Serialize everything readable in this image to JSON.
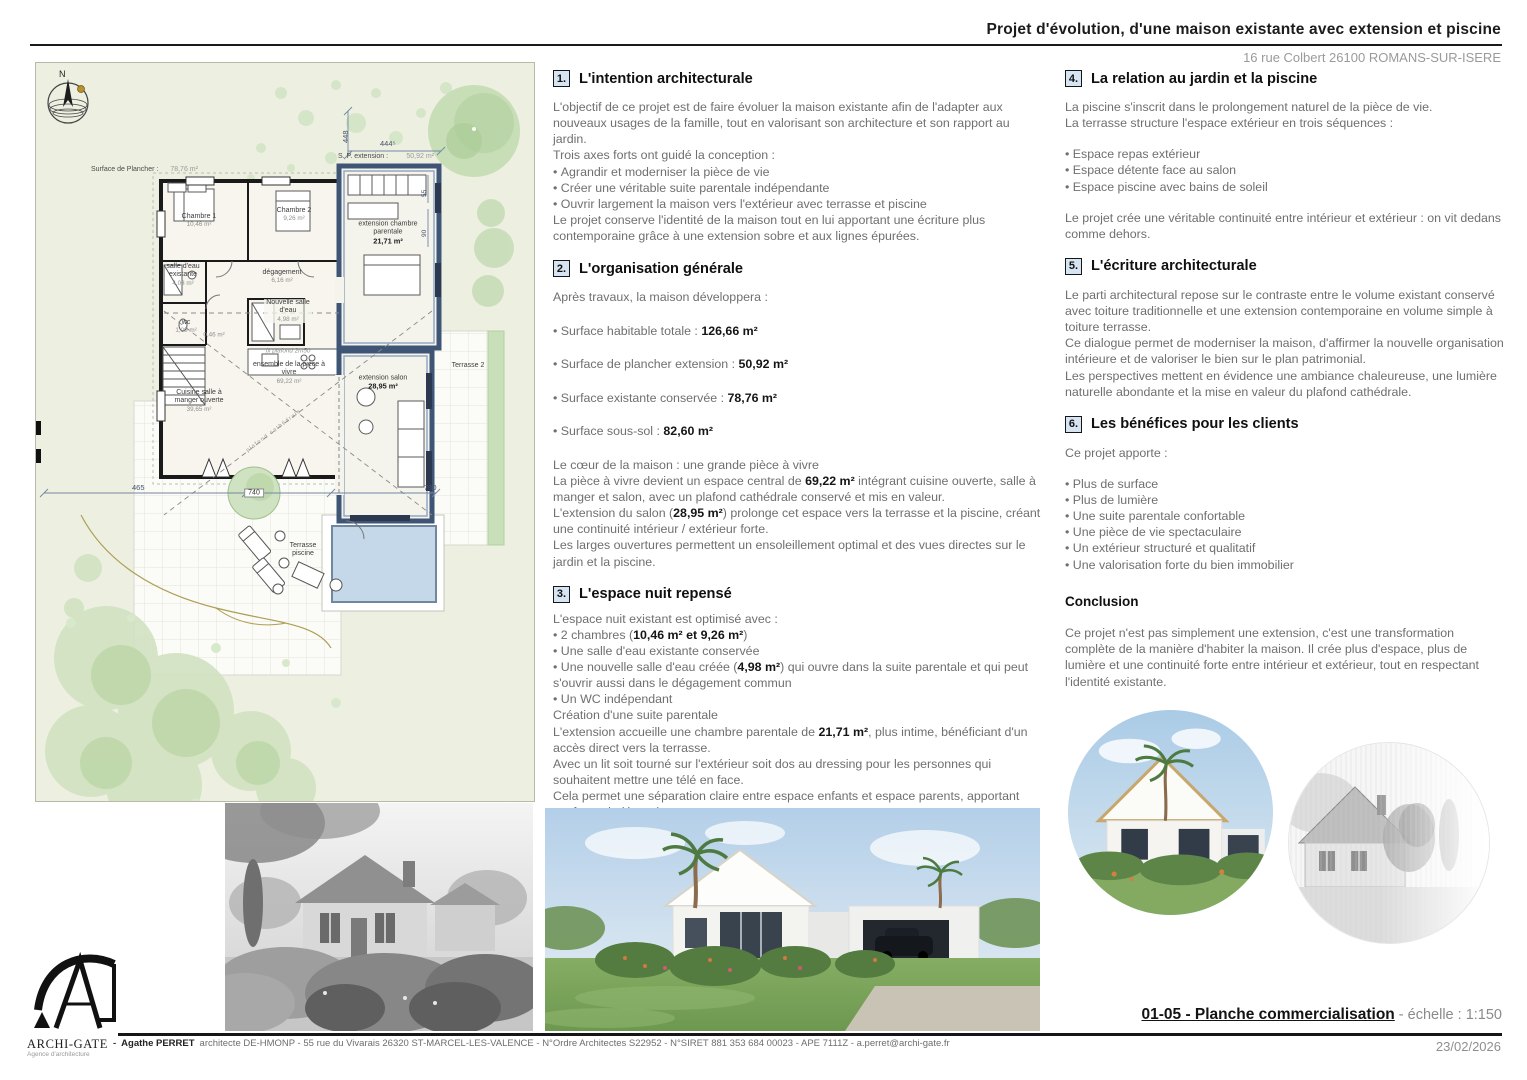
{
  "header": {
    "title": "Projet d'évolution, d'une maison existante avec extension et piscine",
    "address": "16 rue Colbert 26100 ROMANS-SUR-ISERE"
  },
  "plan": {
    "north": "N",
    "surface_plancher": {
      "label": "Surface de Plancher :",
      "value": "78,76 m²"
    },
    "sp_extension": {
      "label": "S. P. extension :",
      "value": "50,92 m²"
    },
    "rooms": {
      "chambre1": {
        "name": "Chambre 1",
        "area": "10,46 m²"
      },
      "chambre2": {
        "name": "Chambre 2",
        "area": "9,26 m²"
      },
      "salle_eau_existante": {
        "name": "salle d'eau existante",
        "area": "4,03 m²"
      },
      "degagement": {
        "name": "dégagement",
        "area": "6,16 m²"
      },
      "nouvelle_salle_eau": {
        "name": "Nouvelle salle d'eau",
        "area": "4,98 m²"
      },
      "wc": {
        "name": "wc",
        "area": "1,00 m²"
      },
      "placard": {
        "area": "0,46 m²"
      },
      "cuisine": {
        "name": "Cuisine salle à manger ouverte",
        "area": "39,65 m²"
      },
      "ensemble": {
        "name": "ensemble de la pièce à vivre",
        "area": "69,22 m²"
      },
      "ext_parentale": {
        "name": "extension chambre parentale",
        "area": "21,71 m²"
      },
      "ext_salon": {
        "name": "extension salon",
        "area": "28,95 m²"
      },
      "terrasse2": {
        "name": "Terrasse 2"
      },
      "terrasse_piscine": {
        "name": "Terrasse piscine"
      }
    },
    "notes": {
      "plafond": "fx plafond 2m50",
      "cathedrale": "plafond cathédrale"
    },
    "dims": {
      "d448": "448",
      "d444": "444⁵",
      "d55": "55",
      "d90": "90",
      "d465": "465",
      "d740": "740",
      "d760": "760"
    }
  },
  "sections": {
    "s1": {
      "num": "1.",
      "title": "L'intention architecturale",
      "p1": "L'objectif de ce projet est de faire évoluer la maison existante afin de l'adapter aux nouveaux usages de la famille, tout en valorisant son architecture et son rapport au jardin.",
      "p2": "Trois axes forts ont guidé la conception :",
      "bullets": [
        "Agrandir et moderniser la pièce de vie",
        "Créer une véritable suite parentale indépendante",
        "Ouvrir largement la maison vers l'extérieur avec terrasse et piscine"
      ],
      "p3": "Le projet conserve l'identité de la maison tout en lui apportant une écriture plus contemporaine grâce à une extension sobre et aux lignes épurées."
    },
    "s2": {
      "num": "2.",
      "title": "L'organisation générale",
      "intro": "Après travaux, la maison développera :",
      "stats": [
        {
          "label": "Surface habitable totale : ",
          "value": "126,66 m²"
        },
        {
          "label": "Surface de plancher extension : ",
          "value": "50,92 m²"
        },
        {
          "label": "Surface existante conservée : ",
          "value": "78,76 m²"
        },
        {
          "label": "Surface sous-sol : ",
          "value": "82,60 m²"
        }
      ],
      "sub": "Le cœur de la maison : une grande pièce à vivre",
      "p1a": "La pièce à vivre devient un espace central de ",
      "p1b": "69,22 m²",
      "p1c": " intégrant cuisine ouverte, salle à manger et salon, avec un plafond cathédrale conservé et mis en valeur.",
      "p2a": "L'extension du salon (",
      "p2b": "28,95 m²",
      "p2c": ") prolonge cet espace vers la terrasse et la piscine, créant une continuité intérieur / extérieur forte.",
      "p3": "Les larges ouvertures permettent un ensoleillement optimal et des vues directes sur le jardin et la piscine."
    },
    "s3": {
      "num": "3.",
      "title": "L'espace nuit repensé",
      "intro": "L'espace nuit existant est optimisé avec :",
      "b1a": "2 chambres (",
      "b1b": "10,46 m² et 9,26 m²",
      "b1c": ")",
      "b2": "Une salle d'eau existante conservée",
      "b3a": "Une nouvelle salle d'eau créée (",
      "b3b": "4,98 m²",
      "b3c": ") qui ouvre dans la suite parentale et qui peut s'ouvrir aussi dans le dégagement commun",
      "b4": "Un WC indépendant",
      "p1": "Création d'une suite parentale",
      "p2a": "L'extension accueille une chambre parentale de ",
      "p2b": "21,71 m²",
      "p2c": ", plus intime, bénéficiant d'un accès direct vers la terrasse.",
      "p3": "Avec un lit soit tourné sur l'extérieur soit dos au dressing pour les personnes qui souhaitent mettre une télé en face.",
      "p4": "Cela permet une séparation claire entre espace enfants et espace parents, apportant confort et indépendance."
    },
    "s4": {
      "num": "4.",
      "title": "La relation au jardin et la piscine",
      "p1": "La piscine s'inscrit dans le prolongement naturel de la pièce de vie.",
      "p2": "La terrasse structure l'espace extérieur en trois séquences :",
      "bullets": [
        "Espace repas extérieur",
        "Espace détente face au salon",
        "Espace piscine avec bains de soleil"
      ],
      "p3": "Le projet crée une véritable continuité entre intérieur et extérieur : on vit dedans comme dehors."
    },
    "s5": {
      "num": "5.",
      "title": "L'écriture architecturale",
      "p1": "Le parti architectural repose sur le contraste entre le volume existant conservé avec toiture traditionnelle et une extension contemporaine en volume simple à toiture terrasse.",
      "p2": "Ce dialogue permet de moderniser la maison, d'affirmer la nouvelle organisation intérieure et de valoriser le bien sur le plan patrimonial.",
      "p3": "Les perspectives mettent en évidence une ambiance chaleureuse, une lumière naturelle abondante et la mise en valeur du plafond cathédrale."
    },
    "s6": {
      "num": "6.",
      "title": "Les bénéfices pour les clients",
      "intro": "Ce projet apporte :",
      "bullets": [
        "Plus de surface",
        "Plus de lumière",
        "Une suite parentale confortable",
        "Une pièce de vie spectaculaire",
        "Un extérieur structuré et qualitatif",
        "Une valorisation forte du bien immobilier"
      ],
      "conclusion_title": "Conclusion",
      "conclusion": "Ce projet n'est pas simplement une extension, c'est une transformation complète de la manière d'habiter la maison. Il crée plus d'espace, plus de lumière et une continuité forte entre intérieur et extérieur, tout en respectant l'identité existante."
    }
  },
  "titleblock": {
    "sheet": "01-05 - Planche commercialisation",
    "scale_sep": " - ",
    "scale": "échelle : 1:150",
    "date": "23/02/2026"
  },
  "footer": {
    "logo_name": "ARCHI-GATE",
    "logo_sub": "Agence d'architecture",
    "sep": "-",
    "architect": "Agathe  PERRET",
    "credits": "architecte DE-HMONP - 55 rue du Vivarais 26320 ST-MARCEL-LES-VALENCE - N°Ordre Architectes S22952 - N°SIRET 881 353 684 00023 - APE 7111Z -  a.perret@archi-gate.fr"
  }
}
